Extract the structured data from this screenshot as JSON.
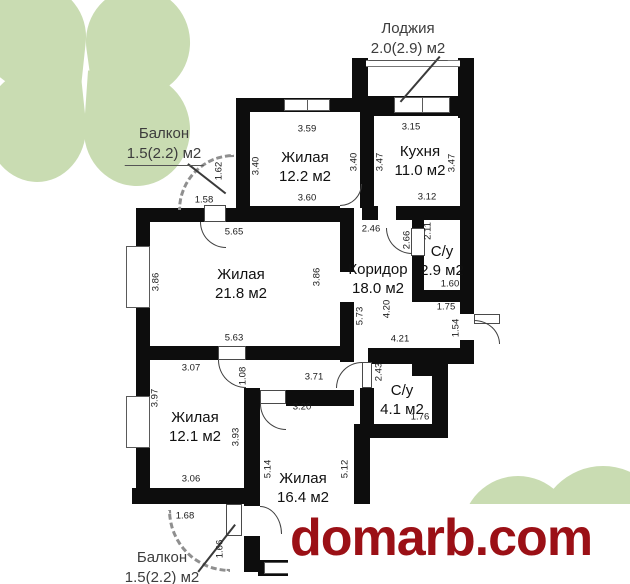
{
  "watermark": {
    "text": "domarb.com",
    "color": "#9b1016"
  },
  "decor": {
    "clover_color": "#c9dcb2"
  },
  "colors": {
    "wall": "#0d0d0d",
    "dimension_text": "#1a1a1a",
    "room_text": "#111111"
  },
  "plan": {
    "rooms": [
      {
        "name": "Жилая",
        "area": "12.2 м2"
      },
      {
        "name": "Кухня",
        "area": "11.0 м2"
      },
      {
        "name": "Жилая",
        "area": "21.8 м2"
      },
      {
        "name": "Коридор",
        "area": "18.0 м2"
      },
      {
        "name": "С/у",
        "area": "2.9 м2"
      },
      {
        "name": "С/у",
        "area": "4.1 м2"
      },
      {
        "name": "Жилая",
        "area": "12.1 м2"
      },
      {
        "name": "Жилая",
        "area": "16.4 м2"
      }
    ],
    "outdoor": [
      {
        "name": "Лоджия",
        "area": "2.0(2.9) м2"
      },
      {
        "name": "Балкон",
        "area": "1.5(2.2) м2"
      },
      {
        "name": "Балкон",
        "area": "1.5(2.2) м2"
      }
    ],
    "dims": [
      "3.59",
      "3.40",
      "3.40",
      "3.60",
      "3.15",
      "3.47",
      "3.47",
      "3.12",
      "1.62",
      "1.58",
      "5.65",
      "3.86",
      "3.86",
      "5.63",
      "2.46",
      "2.66",
      "2.11",
      "1.60",
      "1.75",
      "1.54",
      "4.20",
      "4.21",
      "5.73",
      "3.07",
      "3.97",
      "1.08",
      "3.71",
      "3.20",
      "2.43",
      "1.76",
      "3.93",
      "3.06",
      "5.14",
      "5.12",
      "1.68",
      "1.66"
    ]
  }
}
